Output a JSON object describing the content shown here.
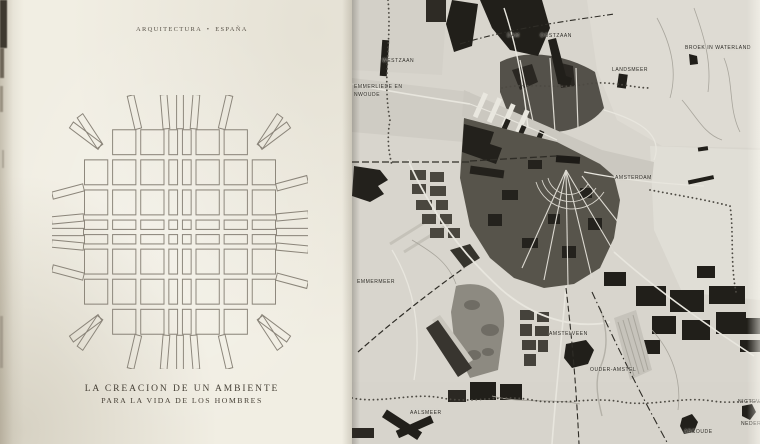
{
  "left_page": {
    "header": "ARQUITECTURA • ESPAÑA",
    "caption": {
      "line1": "LA CREACION DE UN AMBIENTE",
      "line2": "PARA LA VIDA DE LOS HOMBRES"
    }
  },
  "map_page": {
    "labels": [
      {
        "id": "westzaan",
        "text": "WESTZAAN",
        "x": 30,
        "y": 58
      },
      {
        "id": "zaandam-partial",
        "text": "DAM",
        "x": 155,
        "y": 33
      },
      {
        "id": "oostzaan",
        "text": "OOSTZAAN",
        "x": 188,
        "y": 33
      },
      {
        "id": "landsmeer",
        "text": "LANDSMEER",
        "x": 260,
        "y": 67
      },
      {
        "id": "broek-in-waterland",
        "text": "BROEK IN WATERLAND",
        "x": 333,
        "y": 45
      },
      {
        "id": "emmerliede-en",
        "text": "EMMERLIEDE EN",
        "x": 2,
        "y": 84
      },
      {
        "id": "nwoude",
        "text": "NWOUDE",
        "x": 2,
        "y": 92
      },
      {
        "id": "amsterdam",
        "text": "AMSTERDAM",
        "x": 263,
        "y": 175
      },
      {
        "id": "emmermeer",
        "text": "EMMERMEER",
        "x": 5,
        "y": 279
      },
      {
        "id": "amstelveen",
        "text": "AMSTELVEEN",
        "x": 197,
        "y": 331
      },
      {
        "id": "ouder-amstel",
        "text": "OUDER-AMSTEL",
        "x": 238,
        "y": 367
      },
      {
        "id": "aalsmeer",
        "text": "AALSMEER",
        "x": 58,
        "y": 410
      },
      {
        "id": "abcoude",
        "text": "ABCOUDE",
        "x": 332,
        "y": 429
      },
      {
        "id": "nigtevecht-partial",
        "text": "NIGTEVE",
        "x": 386,
        "y": 399
      },
      {
        "id": "nederhorst-partial",
        "text": "NEDERH",
        "x": 389,
        "y": 421
      }
    ]
  },
  "colors": {
    "paper": "#f1eee3",
    "map_bg": "#d8d5cd",
    "ink": "#453f35",
    "label_ink": "#2c2a25",
    "map_black": "#211f1a",
    "map_dark_gray": "#57544b",
    "map_mid_gray": "#8d8a81",
    "road_white": "#e8e6de"
  }
}
